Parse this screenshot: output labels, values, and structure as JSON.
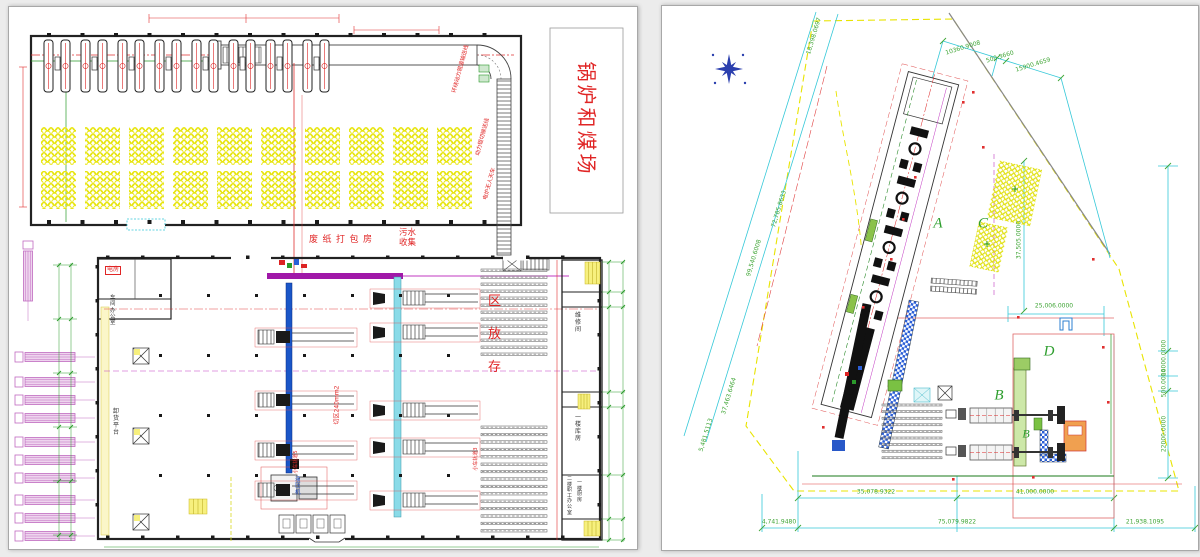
{
  "window": {
    "background": "#ececec",
    "sheet_background": "#ffffff",
    "sheet_border": "#a8a8a8"
  },
  "left_plan": {
    "labels": {
      "boiler_coal_yard": "锅炉和煤场",
      "baling_room": "废纸打包房",
      "sewage_collect": "污水收集",
      "storage_zone_stacked": "区放存",
      "cut_zone": "切区240mm2",
      "cart_rail_3": "小车轨道3",
      "cart_rail_5": "小车轨道5",
      "ring_roller_conveyor": "环绕动力辊道输送线",
      "power_roller_conveyor": "动力辊切输送线",
      "furnace_crane": "电炉无人天车",
      "unload_platform": "卸货平台",
      "electric_room": "电房",
      "workshop_office": "车间办公室",
      "hydraulic_press": "液压机",
      "room_maintenance": "维修间",
      "room_warehouse_1f": "一楼库房",
      "room_staff_office_2f": "二楼职工办公室",
      "room_kitchen_1f": "一楼厨房"
    },
    "coil_storage": {
      "rows": 2,
      "clusters_per_row": 10,
      "circle_color": "#e6e300"
    },
    "truck_docks": {
      "count": 10,
      "color": "#c06ac0"
    },
    "machine_lines": {
      "left_rows": 4,
      "right_rows": 5
    },
    "top_machine_groups": 8,
    "annotation_red": "#e02828"
  },
  "site_plan": {
    "zones": [
      {
        "label": "A"
      },
      {
        "label": "C"
      },
      {
        "label": "D"
      },
      {
        "label": "B"
      },
      {
        "label": "B"
      }
    ],
    "dims": [
      {
        "text": "18,398.0697"
      },
      {
        "text": "10360.9008"
      },
      {
        "text": "500.3660"
      },
      {
        "text": "15900.4659"
      },
      {
        "text": "72,785.8633"
      },
      {
        "text": "99,540.6008"
      },
      {
        "text": "37,463.6464"
      },
      {
        "text": "5,481.5113"
      },
      {
        "text": "37,505.0000"
      },
      {
        "text": "25,006.0000"
      },
      {
        "text": "14000.0000"
      },
      {
        "text": "500.0000"
      },
      {
        "text": "22000.0000"
      },
      {
        "text": "35,078.9322"
      },
      {
        "text": "41,000.0000"
      },
      {
        "text": "4,741.9480"
      },
      {
        "text": "75,079.9822"
      },
      {
        "text": "21,938.1095"
      }
    ],
    "colors": {
      "dim_text": "#3fa535",
      "dim_line": "#35c8d8",
      "boundary": "#e8e400",
      "north": "#2b3fae"
    }
  }
}
